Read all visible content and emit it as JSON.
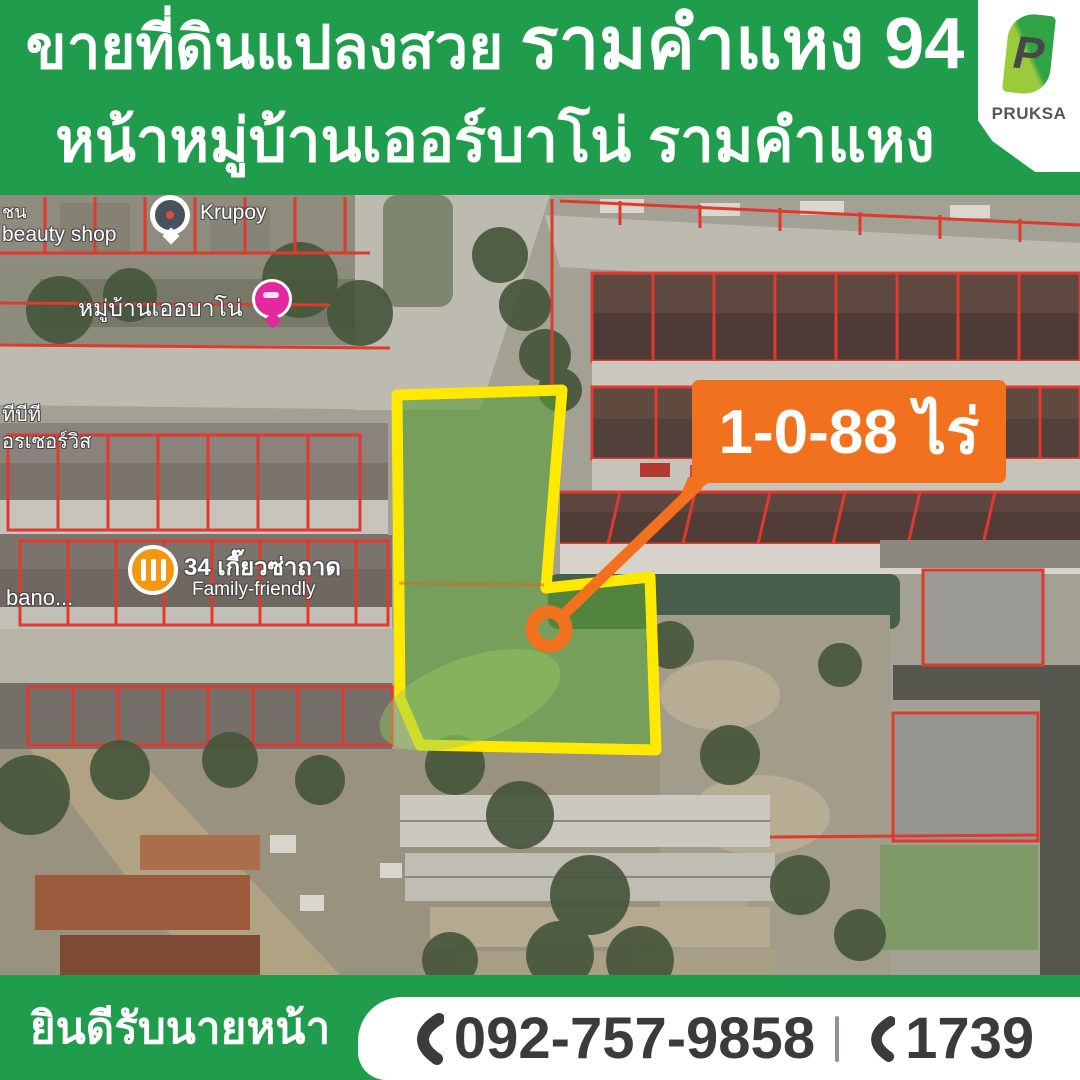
{
  "header": {
    "line1_regular": "ขายที่ดินแปลงสวย",
    "line1_emphasis": "รามคำแหง 94",
    "line2": "หน้าหมู่บ้านเออร์บาโน่ รามคำแหง"
  },
  "logo": {
    "letter": "P",
    "brand": "PRUKSA"
  },
  "map": {
    "area_label": "1-0-88 ไร่",
    "labels": {
      "krupoy": "Krupoy",
      "beauty_shop_partial": "ชน",
      "beauty_shop": "beauty shop",
      "village": "หมู่บ้านเออบาโน่",
      "left_edge_top": "ทีบีที",
      "left_edge_bottom": "อรเซอร์วิส",
      "restaurant": "34 เกี๊ยวซ่าถาด",
      "restaurant_sub": "Family-friendly",
      "urbano_partial": "bano..."
    }
  },
  "footer": {
    "left_text": "ยินดีรับนายหน้า",
    "phone_main": "092-757-9858",
    "phone_hotline": "1739"
  },
  "colors": {
    "brand_green": "#1F9C4C",
    "callout_orange": "#F2711E",
    "plot_yellow": "#FFE900",
    "parcel_red": "#E0392F"
  }
}
